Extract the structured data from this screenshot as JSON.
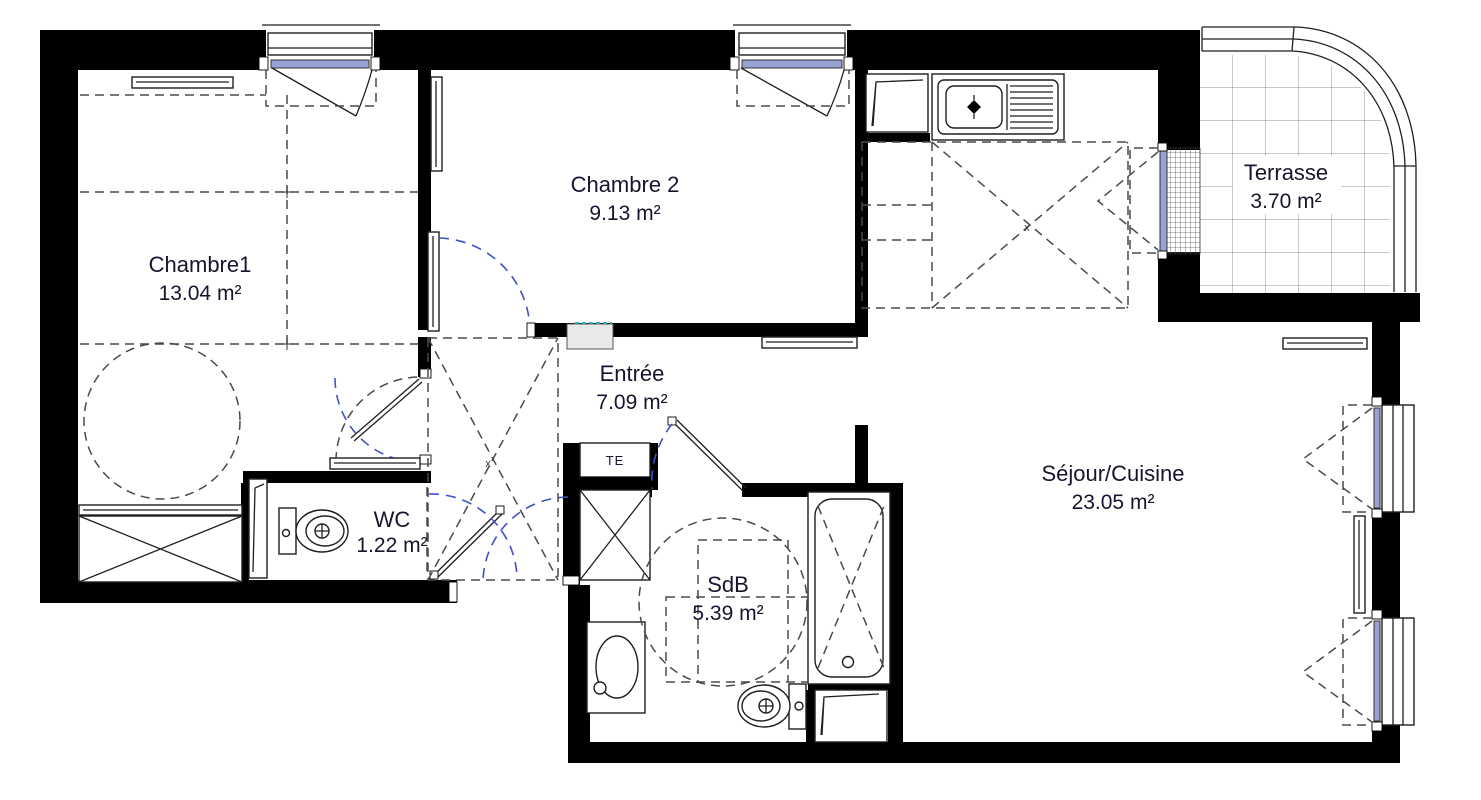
{
  "plan": {
    "title": "Apartment floor plan",
    "rooms": [
      {
        "id": "chambre1",
        "name": "Chambre1",
        "area": "13.04 m²"
      },
      {
        "id": "chambre2",
        "name": "Chambre 2",
        "area": "9.13 m²"
      },
      {
        "id": "entree",
        "name": "Entrée",
        "area": "7.09 m²"
      },
      {
        "id": "wc",
        "name": "WC",
        "area": "1.22 m²"
      },
      {
        "id": "sdb",
        "name": "SdB",
        "area": "5.39 m²"
      },
      {
        "id": "sejour",
        "name": "Séjour/Cuisine",
        "area": "23.05 m²"
      },
      {
        "id": "terrasse",
        "name": "Terrasse",
        "area": "3.70 m²"
      }
    ],
    "labels": {
      "technical_box": "TE",
      "closet_mark": "x",
      "counter_mark": "x"
    },
    "colors": {
      "wall": "#000000",
      "line": "#1f1f1f",
      "glazing": "#98a2d4",
      "door_arc": "#4150c8",
      "dashed_hint": "#4a4a4a",
      "text": "#15152f",
      "tile_grid": "#909090",
      "sill_fill": "#e9e9e9",
      "teal_accent": "#2ab0b0"
    }
  }
}
